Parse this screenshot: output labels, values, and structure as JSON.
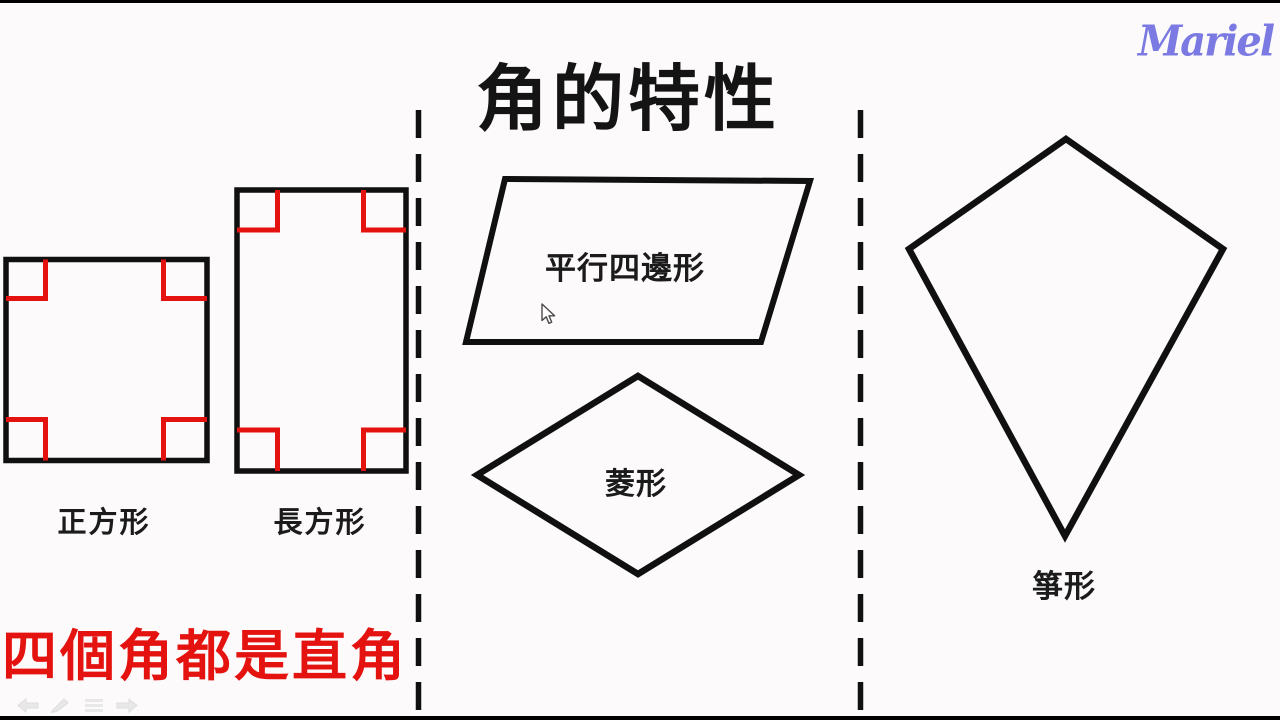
{
  "page": {
    "title": "角的特性",
    "watermark": "Mariel",
    "bottom_note": "四個角都是直角"
  },
  "shapes": [
    {
      "name": "square",
      "label": "正方形"
    },
    {
      "name": "rectangle",
      "label": "長方形"
    },
    {
      "name": "parallelogram",
      "label": "平行四邊形"
    },
    {
      "name": "rhombus",
      "label": "菱形"
    },
    {
      "name": "kite",
      "label": "箏形"
    }
  ],
  "annotations": {
    "right_angle_marks": "red right-angle corner marks on all four corners of the square and the rectangle"
  },
  "toolbar": {
    "icons": [
      "previous-arrow-icon",
      "pen-icon",
      "menu-icon",
      "next-arrow-icon"
    ]
  },
  "colors": {
    "background": "#fcfafb",
    "ink": "#101010",
    "accent-red": "#e41310",
    "watermark-purple": "#7b7ae2",
    "toolbar-gray": "#e8e8e8",
    "letterbox": "#000000"
  }
}
